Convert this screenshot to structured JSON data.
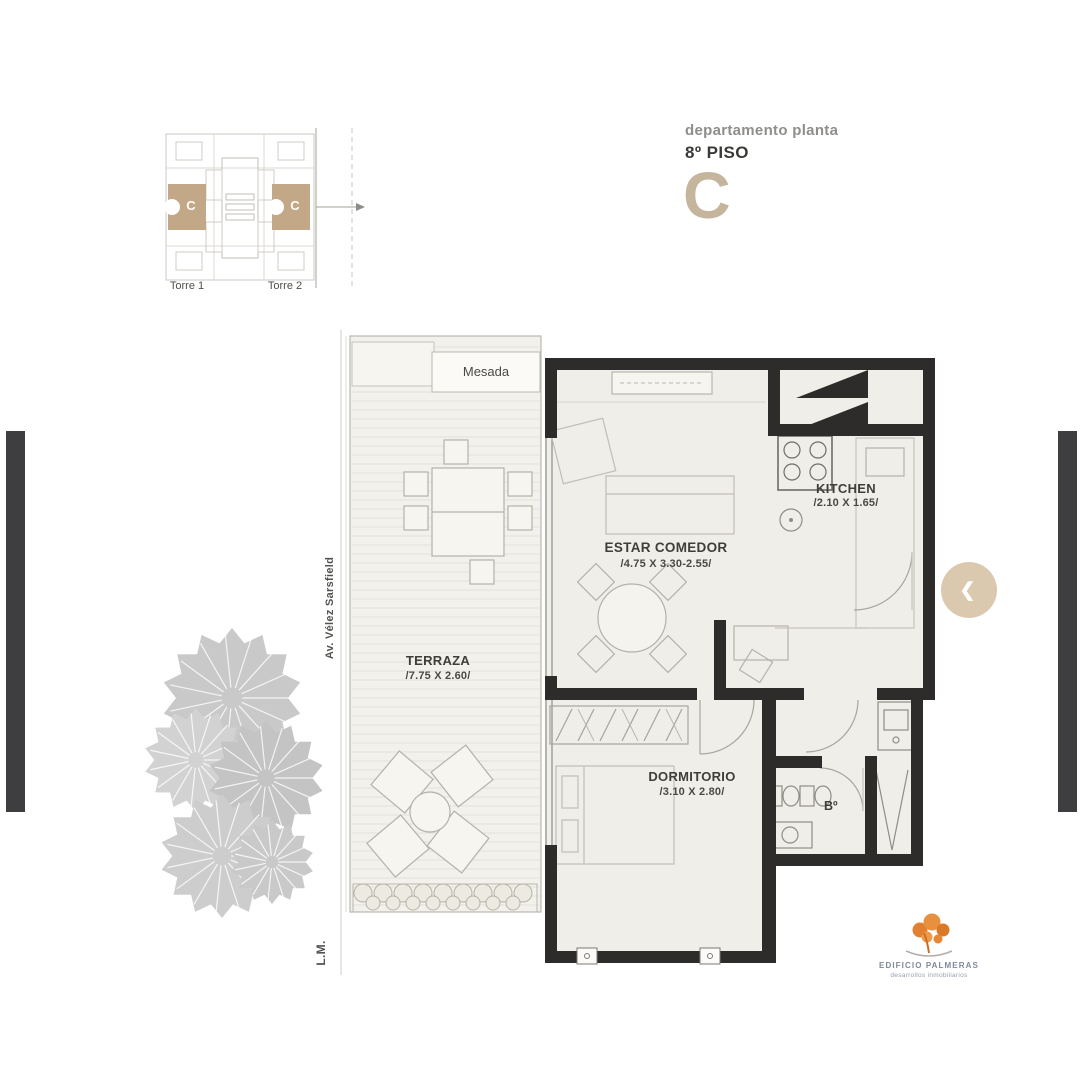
{
  "header": {
    "category": "departamento planta",
    "floor": "8º PISO",
    "unit": "C"
  },
  "key_plan": {
    "tower_1": "Torre 1",
    "tower_2": "Torre 2",
    "unit_marker_1": "C",
    "unit_marker_2": "C"
  },
  "plan": {
    "rooms": {
      "estar": {
        "name": "ESTAR COMEDOR",
        "dims": "/4.75 X 3.30-2.55/"
      },
      "kitchen": {
        "name": "KITCHEN",
        "dims": "/2.10 X 1.65/"
      },
      "terraza": {
        "name": "TERRAZA",
        "dims": "/7.75 X 2.60/"
      },
      "dormitorio": {
        "name": "DORMITORIO",
        "dims": "/3.10 X 2.80/"
      },
      "bath": {
        "name": "Bº"
      }
    },
    "labels": {
      "mesada": "Mesada",
      "street": "Av. Vélez Sarsfield",
      "property_line": "L.M."
    }
  },
  "carousel": {
    "prev_glyph": "❮"
  },
  "logo": {
    "name": "EDIFICIO PALMERAS",
    "tagline": "desarrollos inmobiliarios"
  },
  "colors": {
    "accent_tan": "#c2a886",
    "wall": "#2d2c2a",
    "floor": "#efeee8",
    "side_bar": "#3e3d3f",
    "logo_orange": "#e58733",
    "tree_gray": "#c9c9c9"
  }
}
